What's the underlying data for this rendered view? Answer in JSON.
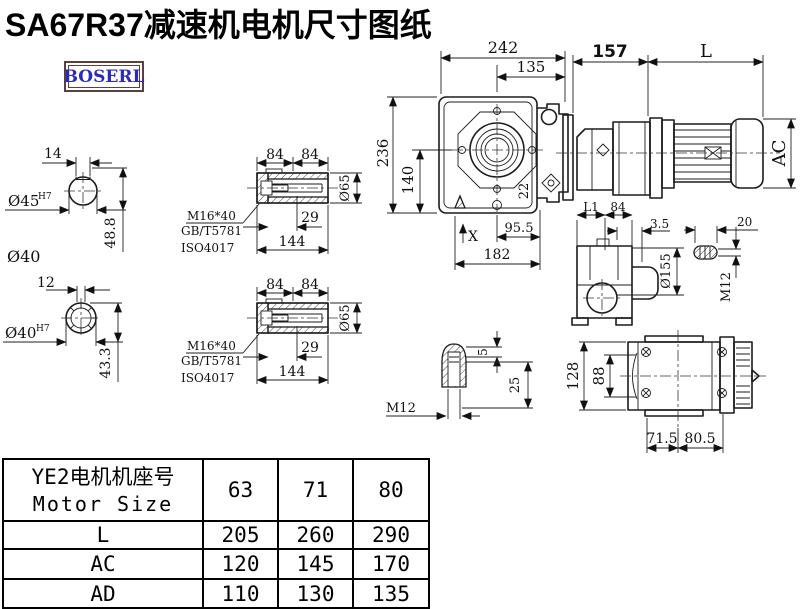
{
  "title": "SA67R37减速机电机尺寸图纸",
  "logo": "BOSERL",
  "drawing": {
    "shaft1": {
      "key_width": "14",
      "bore": "Ø45",
      "tolerance": "H7",
      "depth": "48.8",
      "outer_dia": "Ø40"
    },
    "shaft2": {
      "key_width": "12",
      "bore": "Ø40",
      "tolerance": "H7",
      "depth": "43.3"
    },
    "hollow1": {
      "len_a": "84",
      "len_b": "84",
      "bolt": "M16*40",
      "standard1": "GB/T5781",
      "standard2": "ISO4017",
      "bore_depth": "29",
      "length": "144",
      "dia": "Ø65"
    },
    "hollow2": {
      "len_a": "84",
      "len_b": "84",
      "bolt": "M16*40",
      "standard1": "GB/T5781",
      "standard2": "ISO4017",
      "bore_depth": "29",
      "length": "144",
      "dia": "Ø65"
    },
    "front": {
      "width": "242",
      "to_center": "135",
      "height": "236",
      "center_height": "140",
      "angle": "22",
      "base_a": "95.5",
      "base_b": "182",
      "mark": "X"
    },
    "assembly": {
      "gear_length": "157",
      "motor_length": "L",
      "motor_dia": "AC"
    },
    "side": {
      "l1": "L1",
      "length": "84",
      "gap": "3.5",
      "flange_dia": "Ø155"
    },
    "plug": {
      "length": "20",
      "thread": "M12"
    },
    "shaft_end": {
      "step": "5",
      "depth": "25",
      "thread": "M12"
    },
    "bottom": {
      "height": "128",
      "inner_height": "88",
      "foot_a": "71.5",
      "foot_b": "80.5"
    }
  },
  "table": {
    "header_cn": "YE2电机机座号",
    "header_en": "Motor Size",
    "columns": [
      "63",
      "71",
      "80"
    ],
    "rows": [
      {
        "label": "L",
        "values": [
          "205",
          "260",
          "290"
        ]
      },
      {
        "label": "AC",
        "values": [
          "120",
          "145",
          "170"
        ]
      },
      {
        "label": "AD",
        "values": [
          "110",
          "130",
          "135"
        ]
      }
    ]
  }
}
